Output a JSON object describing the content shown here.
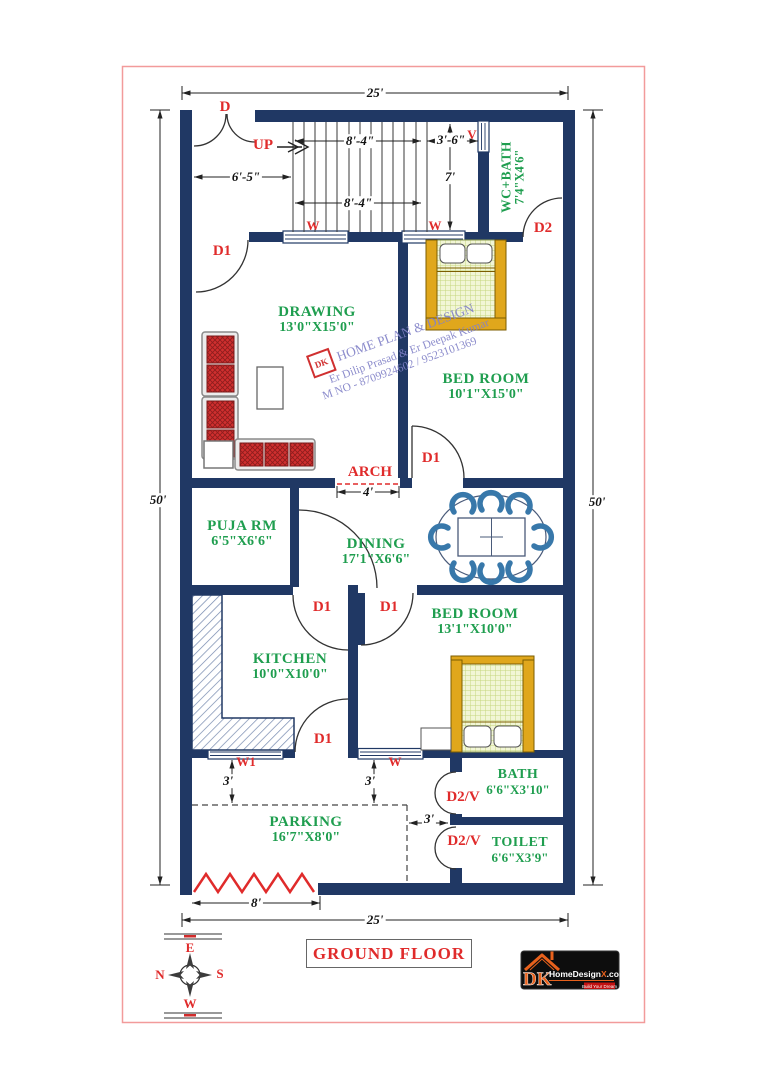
{
  "title": "GROUND FLOOR",
  "plot": {
    "top_width": "25'",
    "bottom_width": "25'",
    "left_height": "50'",
    "right_height": "50'",
    "gate_width": "8'"
  },
  "stairs": {
    "up": "UP",
    "run_top": "8'-4\"",
    "run_bottom": "8'-4\"",
    "landing": "3'-6\"",
    "well_height": "7'",
    "foyer_width": "6'-5\""
  },
  "arch": {
    "label": "ARCH",
    "width": "4'"
  },
  "offsets": {
    "kitchen_setback": "3'",
    "bedroom_setback": "3'",
    "bath_gap": "3'"
  },
  "doors": {
    "main": "D",
    "internal": "D1",
    "wc": "D2",
    "vent": "D2/V"
  },
  "windows": {
    "w": "W",
    "w1": "W1",
    "v": "V"
  },
  "rooms": {
    "drawing": {
      "name": "DRAWING",
      "size": "13'0\"X15'0\""
    },
    "bedroom1": {
      "name": "BED ROOM",
      "size": "10'1\"X15'0\""
    },
    "wc_bath": {
      "name": "WC+BATH",
      "size": "7'4\"X4'6\""
    },
    "puja": {
      "name": "PUJA RM",
      "size": "6'5\"X6'6\""
    },
    "dining": {
      "name": "DINING",
      "size": "17'1\"X6'6\""
    },
    "kitchen": {
      "name": "KITCHEN",
      "size": "10'0\"X10'0\""
    },
    "bedroom2": {
      "name": "BED ROOM",
      "size": "13'1\"X10'0\""
    },
    "bath": {
      "name": "BATH",
      "size": "6'6\"X3'10\""
    },
    "toilet": {
      "name": "TOILET",
      "size": "6'6\"X3'9\""
    },
    "parking": {
      "name": "PARKING",
      "size": "16'7\"X8'0\""
    }
  },
  "watermark": {
    "stamp": "DK",
    "line1": "HOME PLAN & DESIGN",
    "line2": "Er Dilip Prasad & Er Deepak Kumar",
    "line3": "M NO - 8709924602 / 9523101369"
  },
  "compass": {
    "east": "E",
    "west": "W",
    "north": "N",
    "south": "S"
  },
  "logo": {
    "initials": "DK",
    "brand": "HomeDesign",
    "brand_x": "X",
    "brand_tld": ".com",
    "tagline": "Build Your Dream"
  },
  "colors": {
    "wall": "#203864",
    "room_label": "#1f9e4f",
    "annotation": "#e02b2b",
    "dimension": "#111111",
    "plot_border": "#f29b9b",
    "chair": "#3878aa",
    "bed_frame": "#e0a71c",
    "cushion": "#d02f2f"
  }
}
